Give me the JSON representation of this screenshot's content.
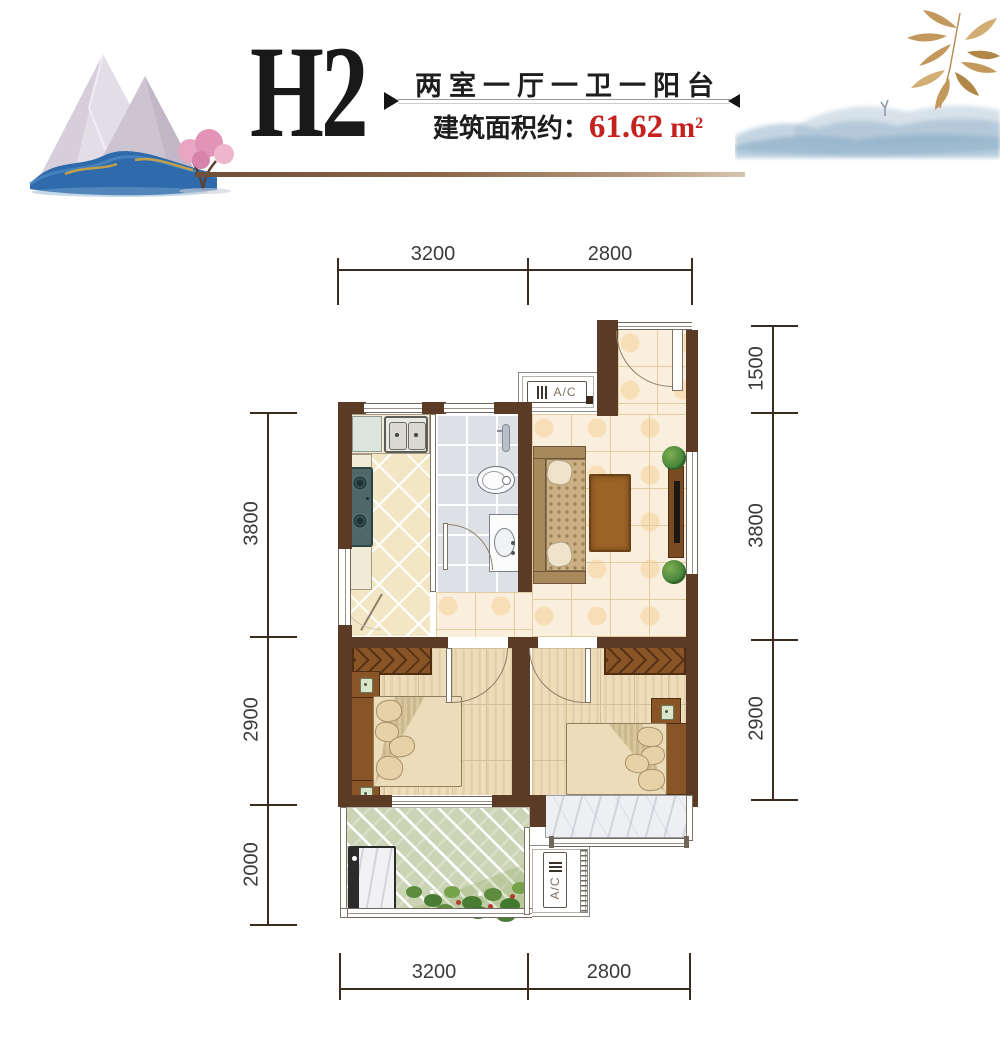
{
  "header": {
    "unit_code": "H2",
    "subtitle": "两室一厅一卫一阳台",
    "area_label": "建筑面积约：",
    "area_value": "61.62",
    "area_unit": "m",
    "area_exponent": "2"
  },
  "plan": {
    "ac_label": "A/C"
  },
  "dimensions": {
    "top": [
      "3200",
      "2800"
    ],
    "bottom": [
      "3200",
      "2800"
    ],
    "left": [
      "3800",
      "2900",
      "2000"
    ],
    "right": [
      "1500",
      "3800",
      "2900"
    ]
  },
  "colors": {
    "wall": "#5b3b26",
    "accent_red": "#c5211e",
    "divider_brown": "#8d6748",
    "dim_line": "#3a2c1e",
    "furniture_brown": "#8a5526"
  }
}
